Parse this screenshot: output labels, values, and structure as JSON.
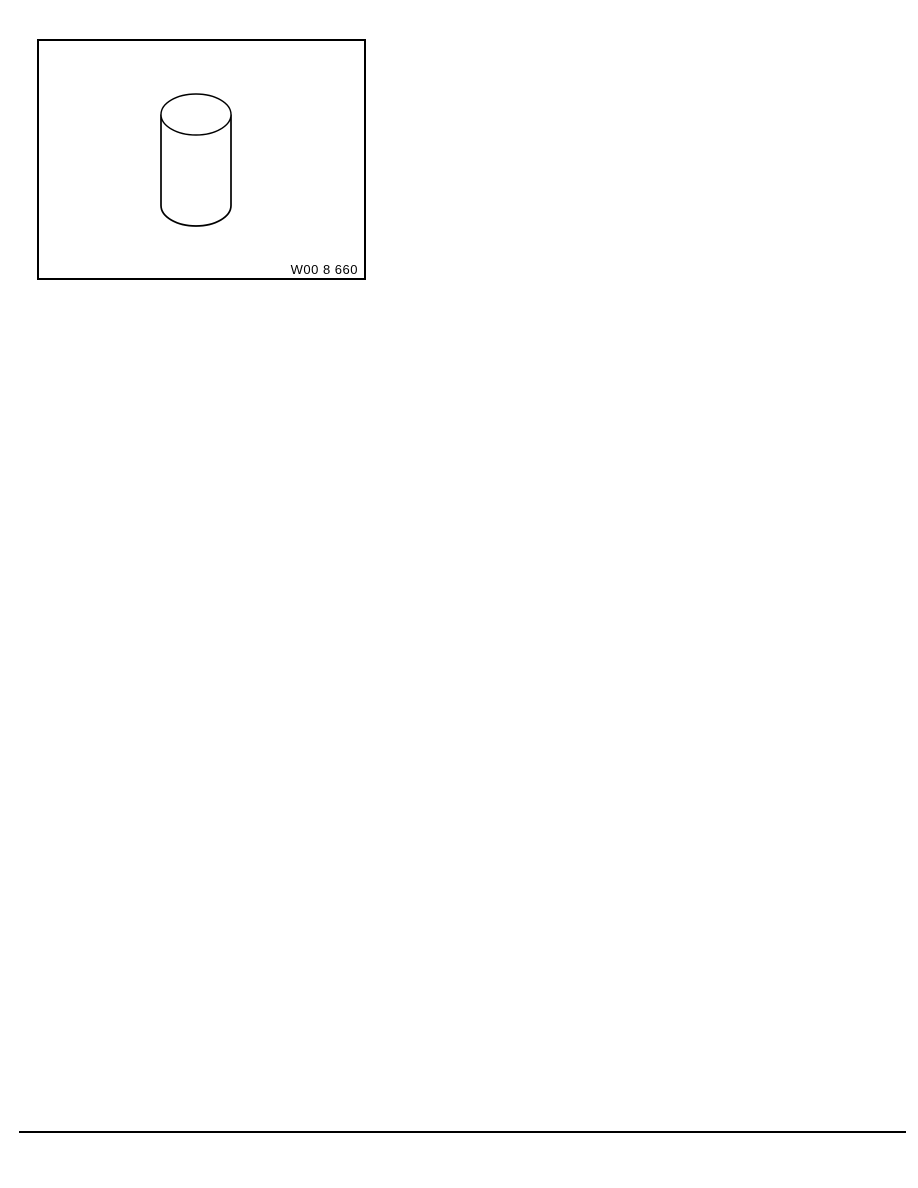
{
  "page": {
    "background_color": "#ffffff"
  },
  "figure": {
    "label": "W00 8 660",
    "alt": "Line drawing of a plain cylinder",
    "frame_color": "#000000",
    "line_color": "#000000"
  },
  "footer_rule": {
    "color": "#000000"
  }
}
